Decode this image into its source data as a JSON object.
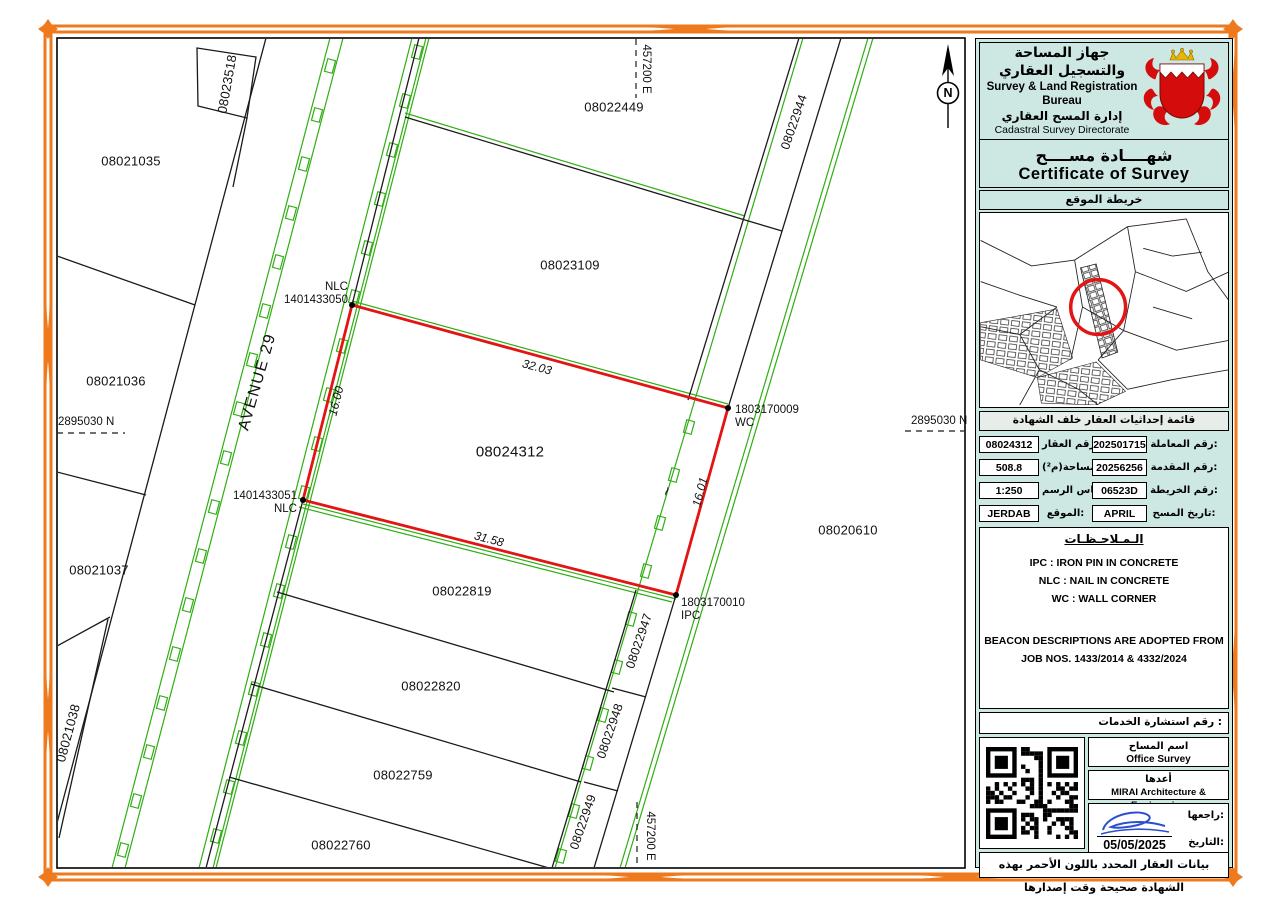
{
  "colors": {
    "border_orange": "#ef7a1e",
    "map_green": "#2fae12",
    "parcel_red": "#e21414",
    "sidebar_bg": "#cde8e2",
    "signature_blue": "#2b4fd0"
  },
  "map": {
    "plots": [
      {
        "label": "08023518"
      },
      {
        "label": "08021035"
      },
      {
        "label": "08021036"
      },
      {
        "label": "08021037"
      },
      {
        "label": "08021038"
      },
      {
        "label": "08022449"
      },
      {
        "label": "08022944"
      },
      {
        "label": "08023109"
      },
      {
        "label": "08024312"
      },
      {
        "label": "08020610"
      },
      {
        "label": "08022819"
      },
      {
        "label": "08022820"
      },
      {
        "label": "08022759"
      },
      {
        "label": "08022760"
      },
      {
        "label": "08022947"
      },
      {
        "label": "08022948"
      },
      {
        "label": "08022949"
      }
    ],
    "points": [
      {
        "line1": "NLC",
        "line2": "1401433050"
      },
      {
        "line1": "1803170009",
        "line2": "WC"
      },
      {
        "line1": "1401433051",
        "line2": "NLC"
      },
      {
        "line1": "1803170010",
        "line2": "IPC"
      }
    ],
    "dims": [
      {
        "label": "32.03"
      },
      {
        "label": "31.58"
      },
      {
        "label": "16.00"
      },
      {
        "label": "16.01"
      },
      {
        "label": "~"
      }
    ],
    "street": "AVENUE 29",
    "north": "N",
    "coords": {
      "top_e": "457200 E",
      "bottom_e": "457200 E",
      "left_n": "2895030 N",
      "right_n": "2895030 N"
    }
  },
  "sidebar": {
    "bureau_ar": "جهاز المساحة والتسجيل العقاري",
    "bureau_en": "Survey & Land Registration Bureau",
    "directorate_ar": "إدارة المسح العقاري",
    "directorate_en": "Cadastral Survey Directorate",
    "title_ar": "شهــــادة مســــح",
    "title_en": "Certificate of Survey",
    "location_map_label": "خريطة الموقع",
    "coords_note": "قائمة إحداثيات العقار خلف الشهادة",
    "table": {
      "rows": [
        {
          "l_value": "08024312",
          "l_label": "رقم العقار:",
          "r_value": "202501715",
          "r_label": "رقم المعاملة:"
        },
        {
          "l_value": "508.8",
          "l_label": "المساحة(م²):",
          "r_value": "20256256",
          "r_label": "رقم المقدمة:"
        },
        {
          "l_value": "1:250",
          "l_label": "مقياس الرسم:",
          "r_value": "06523D",
          "r_label": "رقم الخريطة:"
        },
        {
          "l_value": "JERDAB",
          "l_label": "الموقع:",
          "r_value": "APRIL 2025",
          "r_label": "تاريخ المسح:"
        }
      ]
    },
    "notes": {
      "title": "الـمـلاحـظـات",
      "line1": "IPC : IRON PIN IN CONCRETE",
      "line2": "NLC : NAIL IN CONCRETE",
      "line3": "WC : WALL CORNER",
      "beacon1": "BEACON DESCRIPTIONS ARE ADOPTED FROM",
      "beacon2": "JOB NOS. 1433/2014 & 4332/2024"
    },
    "services_label": "رقم استشارة الخدمات :",
    "surveyor_label": "اسم المساح",
    "surveyor_value": "Office Survey",
    "prepared_label": "أعدها",
    "prepared_value": "MIRAI Architecture & Engineering",
    "reviewed_label": "راجعها:",
    "date_label": "التاريخ:",
    "date_value": "05/05/2025",
    "footer_note": "بيانات العقار المحدد باللون الأحمر بهذه الشهادة صحيحة وقت إصدارها"
  }
}
